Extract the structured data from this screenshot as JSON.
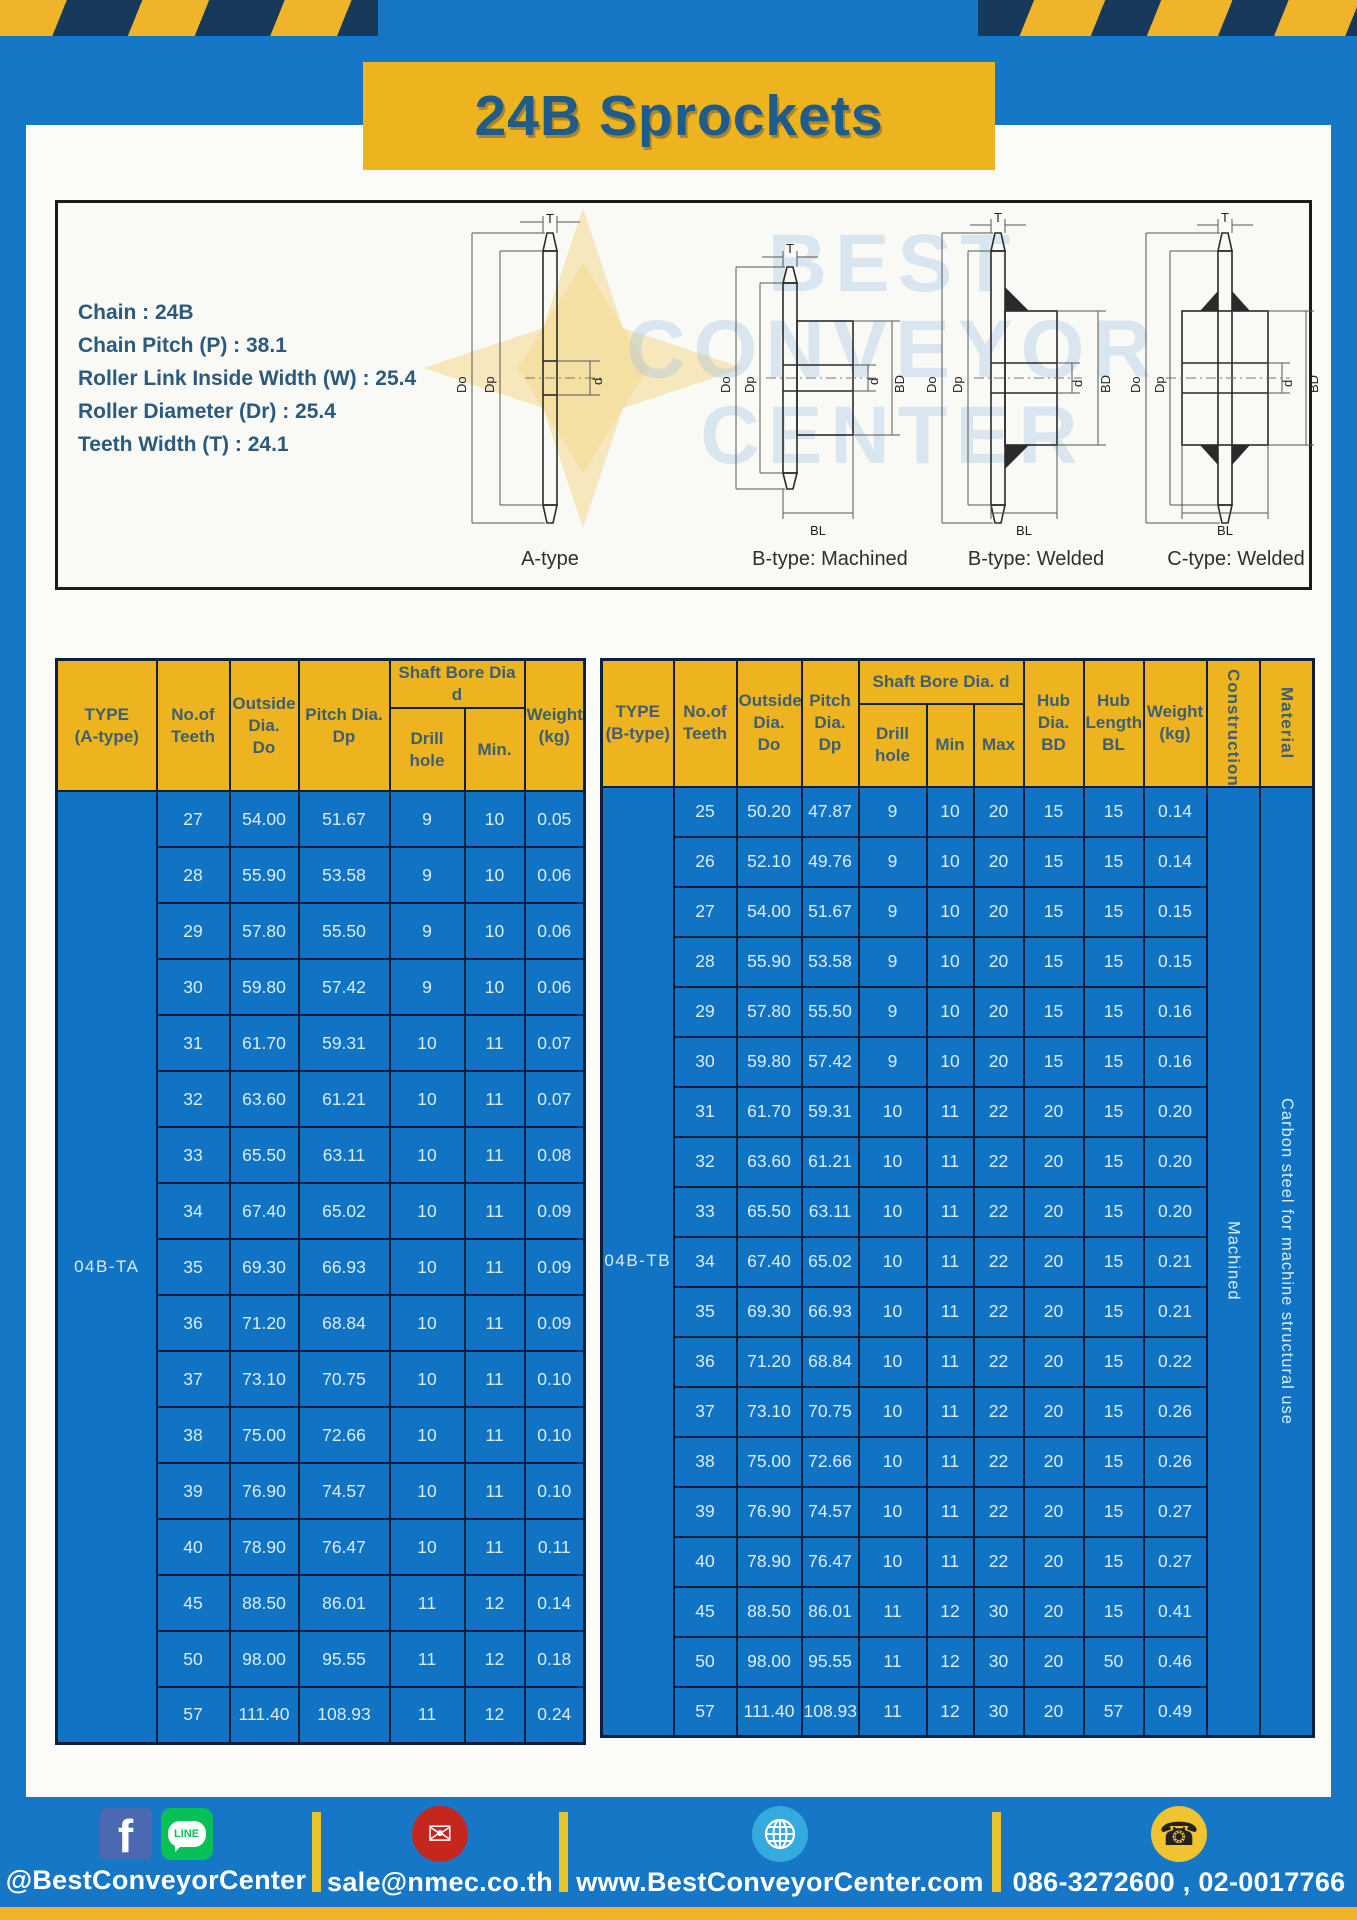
{
  "page": {
    "title": "24B Sprockets"
  },
  "colors": {
    "frame_blue": "#1577c5",
    "accent_yellow": "#eeb41f",
    "stripe_navy": "#17395c",
    "table_body_blue": "#1173c4",
    "table_border_navy": "#0d1f3c",
    "title_text_blue": "#1f5c8b",
    "header_text_slate": "#3e5f70"
  },
  "specs": {
    "lines": [
      "Chain : 24B",
      "Chain Pitch (P) : 38.1",
      "Roller Link Inside Width (W) : 25.4",
      "Roller Diameter (Dr) : 25.4",
      "Teeth Width (T) : 24.1"
    ]
  },
  "diagram": {
    "watermark": {
      "line1": "BEST",
      "line2": "CONVEYOR",
      "line3": "CENTER"
    },
    "captions": [
      "A-type",
      "B-type: Machined",
      "B-type: Welded",
      "C-type: Welded"
    ],
    "dims": {
      "t": "T",
      "outer": "Do",
      "pitch": "Dp",
      "bore": "d",
      "hub_dia": "BD",
      "hub_len": "BL"
    }
  },
  "table_a": {
    "type_label": "04B-TA",
    "headers": {
      "type": "TYPE\n(A-type)",
      "teeth": "No.of\nTeeth",
      "outside": "Outside\nDia.\nDo",
      "pitch": "Pitch Dia.\nDp",
      "shaft_bore": "Shaft Bore Dia d",
      "drill": "Drill hole",
      "min": "Min.",
      "weight": "Weight\n(kg)"
    },
    "rows": [
      [
        "27",
        "54.00",
        "51.67",
        "9",
        "10",
        "0.05"
      ],
      [
        "28",
        "55.90",
        "53.58",
        "9",
        "10",
        "0.06"
      ],
      [
        "29",
        "57.80",
        "55.50",
        "9",
        "10",
        "0.06"
      ],
      [
        "30",
        "59.80",
        "57.42",
        "9",
        "10",
        "0.06"
      ],
      [
        "31",
        "61.70",
        "59.31",
        "10",
        "11",
        "0.07"
      ],
      [
        "32",
        "63.60",
        "61.21",
        "10",
        "11",
        "0.07"
      ],
      [
        "33",
        "65.50",
        "63.11",
        "10",
        "11",
        "0.08"
      ],
      [
        "34",
        "67.40",
        "65.02",
        "10",
        "11",
        "0.09"
      ],
      [
        "35",
        "69.30",
        "66.93",
        "10",
        "11",
        "0.09"
      ],
      [
        "36",
        "71.20",
        "68.84",
        "10",
        "11",
        "0.09"
      ],
      [
        "37",
        "73.10",
        "70.75",
        "10",
        "11",
        "0.10"
      ],
      [
        "38",
        "75.00",
        "72.66",
        "10",
        "11",
        "0.10"
      ],
      [
        "39",
        "76.90",
        "74.57",
        "10",
        "11",
        "0.10"
      ],
      [
        "40",
        "78.90",
        "76.47",
        "10",
        "11",
        "0.11"
      ],
      [
        "45",
        "88.50",
        "86.01",
        "11",
        "12",
        "0.14"
      ],
      [
        "50",
        "98.00",
        "95.55",
        "11",
        "12",
        "0.18"
      ],
      [
        "57",
        "111.40",
        "108.93",
        "11",
        "12",
        "0.24"
      ]
    ]
  },
  "table_b": {
    "type_label": "04B-TB",
    "construction": "Machined",
    "material": "Carbon steel for machine structural use",
    "headers": {
      "type": "TYPE\n(B-type)",
      "teeth": "No.of\nTeeth",
      "outside": "Outside\nDia.\nDo",
      "pitch": "Pitch\nDia.\nDp",
      "shaft_bore": "Shaft Bore Dia. d",
      "drill": "Drill hole",
      "min": "Min",
      "max": "Max",
      "hub_dia": "Hub\nDia.\nBD",
      "hub_len": "Hub\nLength\nBL",
      "weight": "Weight\n(kg)",
      "construction": "Construction",
      "material": "Material"
    },
    "rows": [
      [
        "25",
        "50.20",
        "47.87",
        "9",
        "10",
        "20",
        "15",
        "15",
        "0.14"
      ],
      [
        "26",
        "52.10",
        "49.76",
        "9",
        "10",
        "20",
        "15",
        "15",
        "0.14"
      ],
      [
        "27",
        "54.00",
        "51.67",
        "9",
        "10",
        "20",
        "15",
        "15",
        "0.15"
      ],
      [
        "28",
        "55.90",
        "53.58",
        "9",
        "10",
        "20",
        "15",
        "15",
        "0.15"
      ],
      [
        "29",
        "57.80",
        "55.50",
        "9",
        "10",
        "20",
        "15",
        "15",
        "0.16"
      ],
      [
        "30",
        "59.80",
        "57.42",
        "9",
        "10",
        "20",
        "15",
        "15",
        "0.16"
      ],
      [
        "31",
        "61.70",
        "59.31",
        "10",
        "11",
        "22",
        "20",
        "15",
        "0.20"
      ],
      [
        "32",
        "63.60",
        "61.21",
        "10",
        "11",
        "22",
        "20",
        "15",
        "0.20"
      ],
      [
        "33",
        "65.50",
        "63.11",
        "10",
        "11",
        "22",
        "20",
        "15",
        "0.20"
      ],
      [
        "34",
        "67.40",
        "65.02",
        "10",
        "11",
        "22",
        "20",
        "15",
        "0.21"
      ],
      [
        "35",
        "69.30",
        "66.93",
        "10",
        "11",
        "22",
        "20",
        "15",
        "0.21"
      ],
      [
        "36",
        "71.20",
        "68.84",
        "10",
        "11",
        "22",
        "20",
        "15",
        "0.22"
      ],
      [
        "37",
        "73.10",
        "70.75",
        "10",
        "11",
        "22",
        "20",
        "15",
        "0.26"
      ],
      [
        "38",
        "75.00",
        "72.66",
        "10",
        "11",
        "22",
        "20",
        "15",
        "0.26"
      ],
      [
        "39",
        "76.90",
        "74.57",
        "10",
        "11",
        "22",
        "20",
        "15",
        "0.27"
      ],
      [
        "40",
        "78.90",
        "76.47",
        "10",
        "11",
        "22",
        "20",
        "15",
        "0.27"
      ],
      [
        "45",
        "88.50",
        "86.01",
        "11",
        "12",
        "30",
        "20",
        "15",
        "0.41"
      ],
      [
        "50",
        "98.00",
        "95.55",
        "11",
        "12",
        "30",
        "20",
        "50",
        "0.46"
      ],
      [
        "57",
        "111.40",
        "108.93",
        "11",
        "12",
        "30",
        "20",
        "57",
        "0.49"
      ]
    ]
  },
  "footer": {
    "social": "@BestConveyorCenter",
    "email": "sale@nmec.co.th",
    "website": "www.BestConveyorCenter.com",
    "phone": "086-3272600 , 02-0017766",
    "fb_glyph": "f",
    "line_label": "LINE",
    "mail_glyph": "✉",
    "phone_glyph": "☎"
  }
}
